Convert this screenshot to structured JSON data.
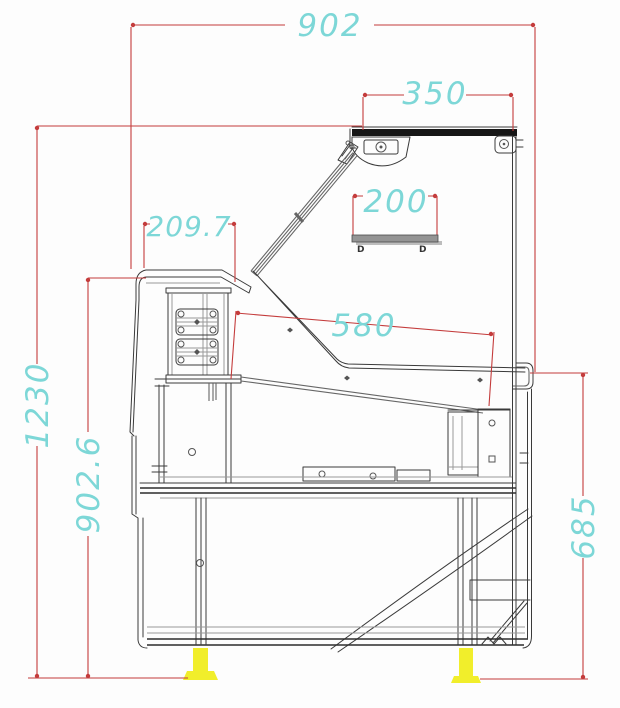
{
  "drawing": {
    "type": "technical-section-drawing",
    "dimensions": {
      "total_width": "902",
      "canopy_width": "350",
      "shelf_width": "200",
      "worktop_depth": "209.7",
      "deck_length": "580",
      "total_height": "1230",
      "worktop_height": "902.6",
      "front_height": "685"
    },
    "markers": {
      "shelf_left": "D",
      "shelf_right": "D"
    },
    "colors": {
      "dimension_line": "#c43c3c",
      "dimension_text": "#7dd7d7",
      "foot": "#f1ee2b",
      "linework": "#3a3a3a"
    }
  }
}
